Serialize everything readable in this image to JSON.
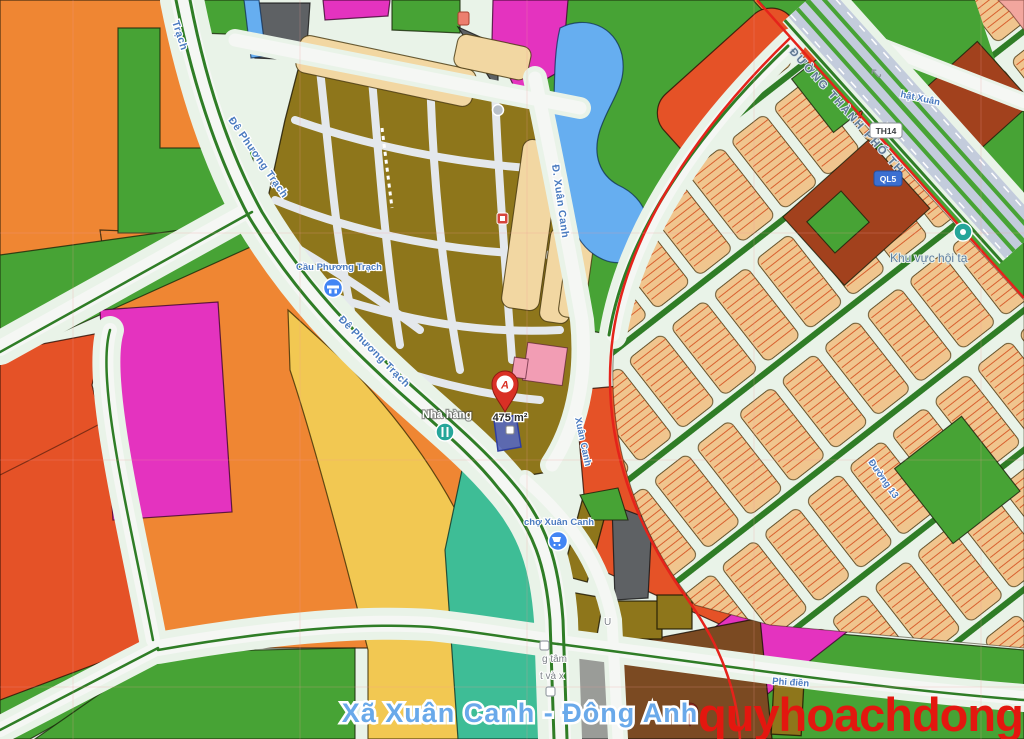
{
  "map": {
    "town_label": "Xã Xuân Canh - Đông Anh",
    "watermark": "quyhoachdonganh.com",
    "parcel": {
      "area_label": "475 m²"
    },
    "road_labels": {
      "de_phuong_trach_top": "Trạch",
      "de_phuong_trach_mid": "Đê Phương Trạch",
      "de_phuong_trach_low": "Đê Phương Trạch",
      "d_xuan_canh": "Đ. Xuân Canh",
      "xuan_canh_low": "Xuân Canh",
      "duong_thanh_pho": "ĐƯỜNG THÀNH PHỐ TH",
      "nhat_xuan": "hật Xuân",
      "duong_13": "Đường 13",
      "phi_dien": "Phi điền"
    },
    "poi_labels": {
      "cau_phuong_trach": "Cầu Phương Trạch",
      "nha_hang": "Nhà hàng",
      "cho_xuan_canh": "chợ Xuân Canh",
      "khu_vuc": "Khu vực hội tạ",
      "g_tam": "g tâm",
      "t_va_x": "t và x",
      "u_partial": "U"
    },
    "shields": {
      "th14": "TH14",
      "ql5": "QL5"
    },
    "marker_letter": "A",
    "uturn_glyph": "↩"
  },
  "colors": {
    "mint": "#E9F3E8",
    "green": "#47A335",
    "green_dark": "#2F7D26",
    "orange": "#EF8633",
    "olive": "#8E761B",
    "magenta": "#E433BF",
    "red_orange": "#E55227",
    "yellow": "#F2C852",
    "tan": "#F2D7A2",
    "lot_tan": "#F0C58E",
    "lot_stripe": "#D8602F",
    "water": "#66AEF0",
    "teal": "#3EBD96",
    "dark_gray": "#5E6164",
    "light_gray": "#9A9C98",
    "brick": "#A2411D",
    "brown": "#7B4A22",
    "pink": "#F29DB4",
    "salmon": "#F2A69E",
    "road_white": "#F5F7F4",
    "street_gray": "#E4E8EC",
    "highway": "#C3CCDC",
    "boundary_red": "#E5231B",
    "marker_red": "#D93025",
    "poi_blue": "#4285F4",
    "poi_teal": "#26A69A",
    "parcel_blue": "#5668C0"
  }
}
